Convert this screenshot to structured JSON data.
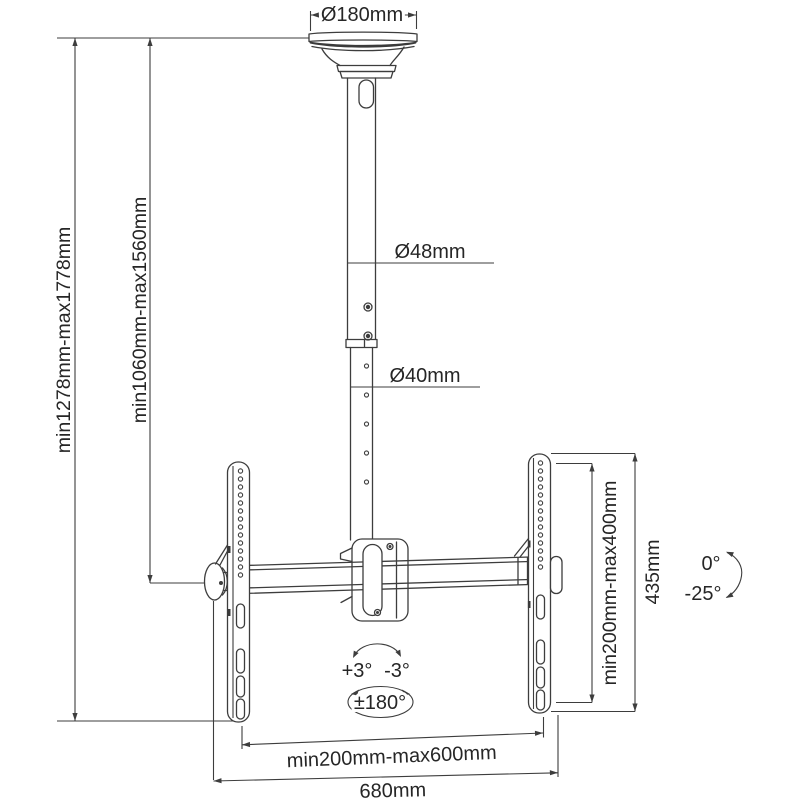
{
  "diagram": {
    "dimensions": {
      "ceiling_plate_diameter": "Ø180mm",
      "upper_pole_diameter": "Ø48mm",
      "lower_pole_diameter": "Ø40mm",
      "overall_height_range": "min1278mm-max1778mm",
      "pole_height_range": "min1060mm-max1560mm",
      "vesa_height_range": "min200mm-max400mm",
      "bracket_height": "435mm",
      "vesa_width_range": "min200mm-max600mm",
      "overall_width": "680mm"
    },
    "angles": {
      "tilt_up": "0°",
      "tilt_down": "-25°",
      "level_plus": "+3°",
      "level_minus": "-3°",
      "rotation": "±180°"
    },
    "colors": {
      "line": "#3d3d3d",
      "text": "#262626",
      "background": "#ffffff"
    }
  }
}
